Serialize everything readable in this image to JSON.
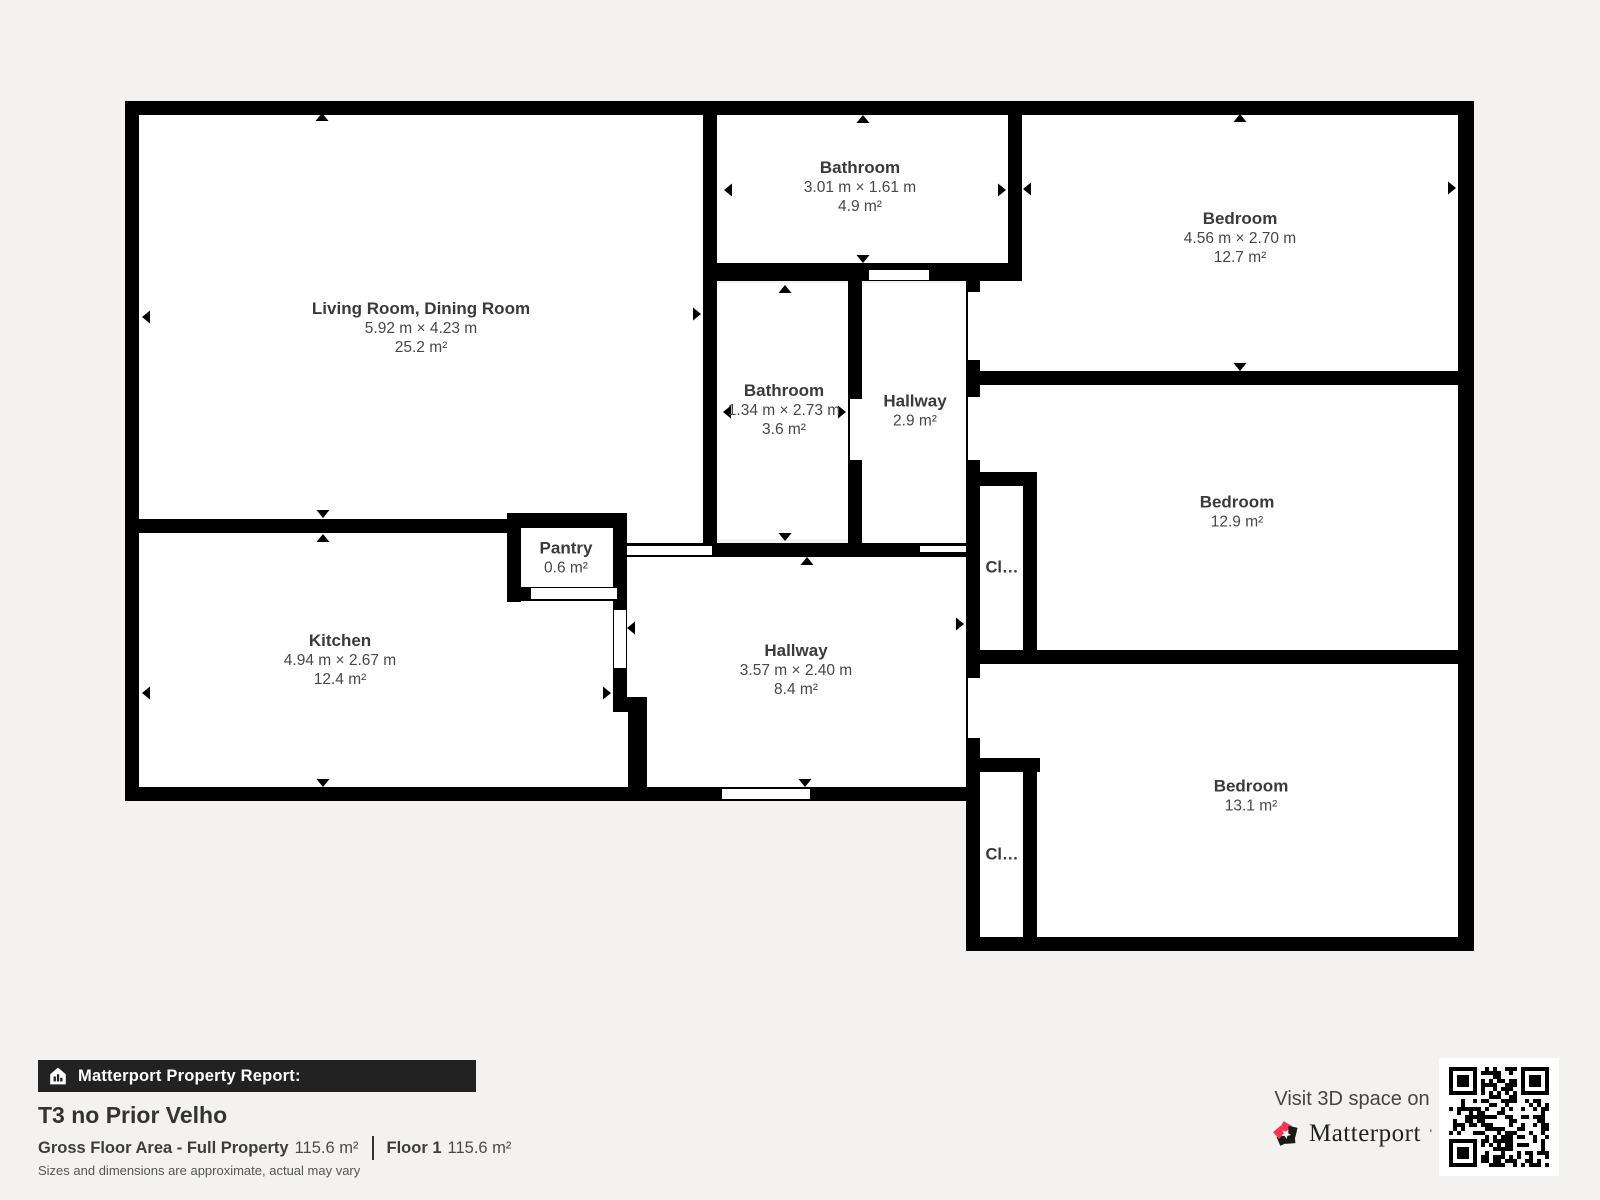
{
  "plan": {
    "wall_color": "#000000",
    "room_color": "#ffffff",
    "background_color": "#f3f2f0",
    "rooms": [
      {
        "name": "Living Room, Dining Room",
        "dims": "5.92 m × 4.23 m",
        "area": "25.2 m²"
      },
      {
        "name": "Bathroom",
        "dims": "3.01 m × 1.61 m",
        "area": "4.9 m²"
      },
      {
        "name": "Bedroom",
        "dims": "4.56 m × 2.70 m",
        "area": "12.7 m²"
      },
      {
        "name": "Bathroom",
        "dims": "1.34 m × 2.73 m",
        "area": "3.6 m²"
      },
      {
        "name": "Hallway",
        "area": "2.9 m²"
      },
      {
        "name": "Bedroom",
        "area": "12.9 m²"
      },
      {
        "name": "Kitchen",
        "dims": "4.94 m × 2.67 m",
        "area": "12.4 m²"
      },
      {
        "name": "Pantry",
        "area": "0.6 m²"
      },
      {
        "name": "Hallway",
        "dims": "3.57 m × 2.40 m",
        "area": "8.4 m²"
      },
      {
        "name": "Bedroom",
        "area": "13.1 m²"
      },
      {
        "name": "Cl…"
      },
      {
        "name": "Cl…"
      }
    ]
  },
  "footer": {
    "bar_label": "Matterport Property Report:",
    "property_title": "T3 no Prior Velho",
    "gross_label": "Gross Floor Area - Full Property",
    "gross_value": "115.6 m²",
    "floor_label": "Floor 1",
    "floor_value": "115.6 m²",
    "note": "Sizes and dimensions are approximate, actual may vary",
    "bar_color": "#222222"
  },
  "visit_panel": {
    "visit_text": "Visit 3D space on",
    "brand": "Matterport",
    "brand_red": "#fb3357",
    "brand_black": "#1a1a1a"
  }
}
